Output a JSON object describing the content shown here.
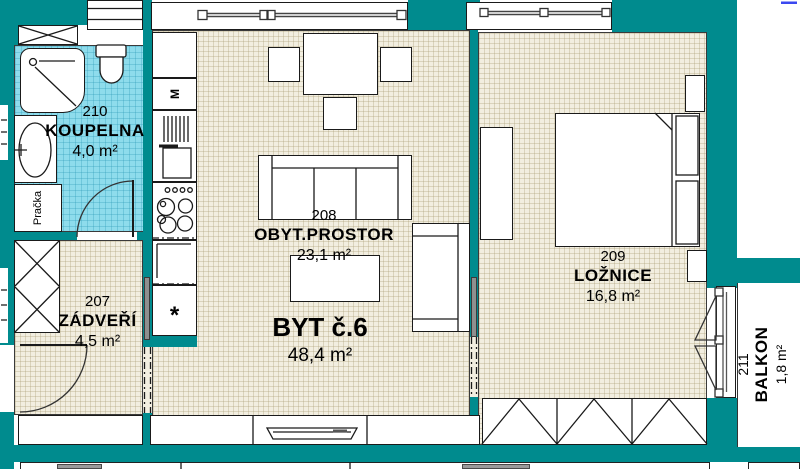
{
  "plan": {
    "apartment": {
      "title": "BYT č.6",
      "area": "48,4 m²"
    },
    "rooms": {
      "bathroom": {
        "id": "210",
        "name": "KOUPELNA",
        "area": "4,0 m²"
      },
      "hall": {
        "id": "207",
        "name": "ZÁDVEŘÍ",
        "area": "4,5 m²"
      },
      "living": {
        "id": "208",
        "name": "OBYT.PROSTOR",
        "area": "23,1 m²"
      },
      "bedroom": {
        "id": "209",
        "name": "LOŽNICE",
        "area": "16,8 m²"
      },
      "balcony": {
        "id": "211",
        "name": "BALKON",
        "area": "1,8 m²"
      }
    },
    "fixtures": {
      "washing_machine": "Pračka",
      "appliance_m": "M",
      "fridge_symbol": "*"
    },
    "colors": {
      "wall": "#008b8e",
      "bathroom_floor": "#8edcec",
      "floor_beige": "#f2eee0",
      "accent_line": "#3b48f0"
    }
  }
}
